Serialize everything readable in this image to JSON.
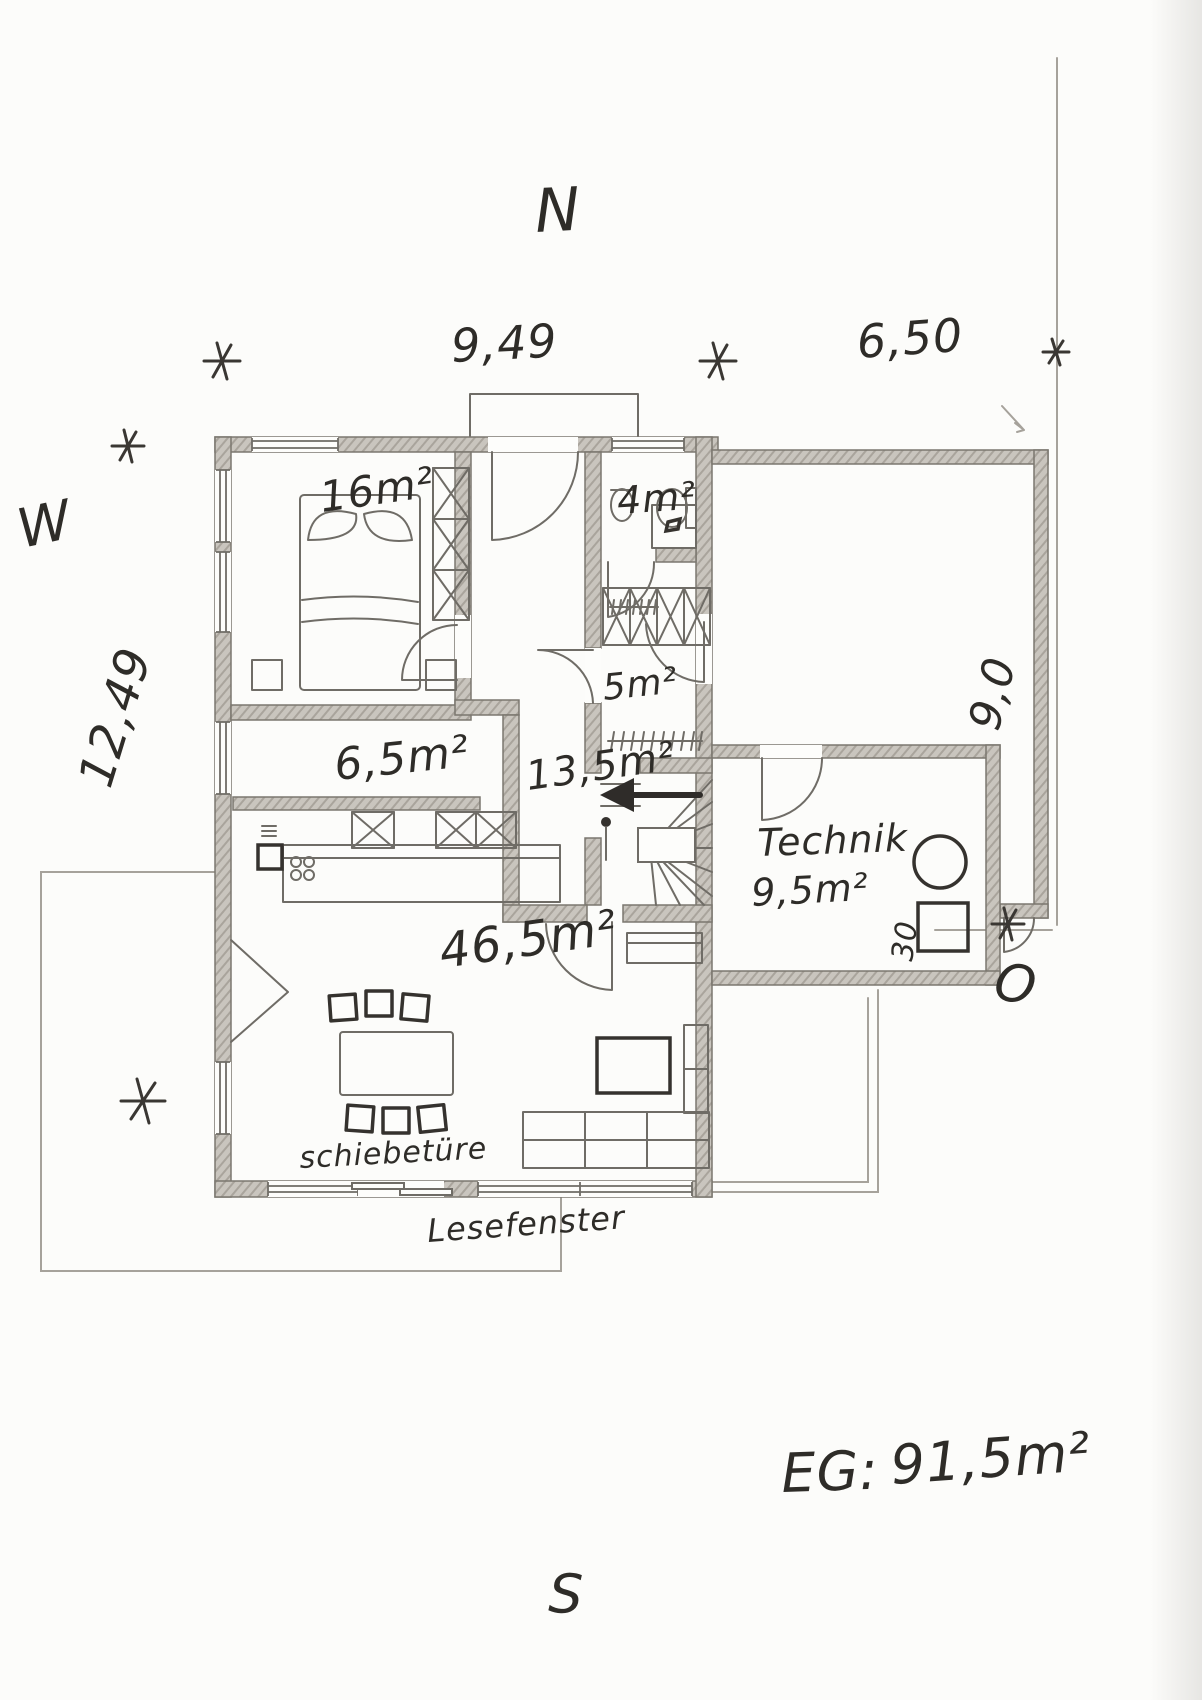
{
  "document": {
    "type": "hand-drawn ground floor plan",
    "floor_total_label": "EG:",
    "floor_total_area": "91,5m²"
  },
  "compass": {
    "north": "N",
    "south": "S",
    "west": "W",
    "east": "O"
  },
  "dimensions": {
    "house_width": "9,49",
    "garage_width": "6,50",
    "house_depth": "12,49",
    "garage_depth": "9,0",
    "technik_clearance": "30"
  },
  "rooms": {
    "bedroom": {
      "area": "16m²"
    },
    "bathroom": {
      "area": "4m²"
    },
    "hallway": {
      "area": "5m²"
    },
    "kitchen": {
      "area": "6,5m²"
    },
    "entry": {
      "area": "13,5m²"
    },
    "living": {
      "area": "46,5m²"
    },
    "technik": {
      "name": "Technik",
      "area": "9,5m²"
    }
  },
  "annotations": {
    "sliding_door": "schiebetüre",
    "reading_window": "Lesefenster"
  }
}
